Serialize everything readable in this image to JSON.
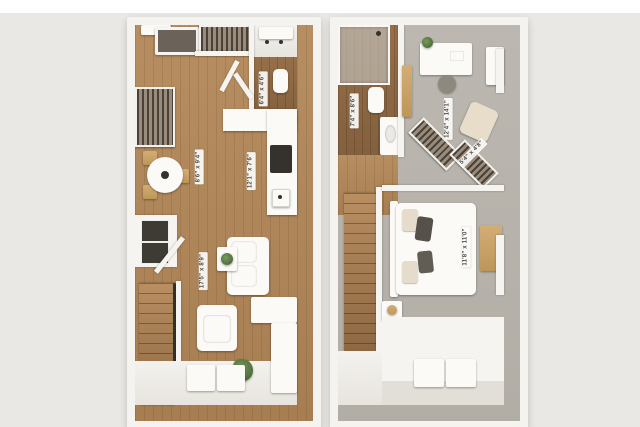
{
  "scene": {
    "background": "#eae8e4",
    "top_margin_color": "#ffffff",
    "wall_color": "#f5f3ef",
    "wood_color": "#ab8256",
    "carpet_color": "#b7b3ac",
    "accent_gold": "#c9a46a",
    "plant_green": "#5e7d4a"
  },
  "plans": [
    {
      "name": "level-1",
      "labels": {
        "utility": "6'4\" x 4'6\"",
        "dining": "8'6\" x 9'4\"",
        "kitchen": "12'1\" x 7'6\"",
        "living": "17'5\" x 8'9\""
      }
    },
    {
      "name": "level-2",
      "labels": {
        "bathroom": "7'4\" x 8'6\"",
        "loft": "12'4\" x 14'1\"",
        "closet": "5'4\" x 4'8\"",
        "bedroom": "11'8\" x 11'0\""
      }
    }
  ]
}
